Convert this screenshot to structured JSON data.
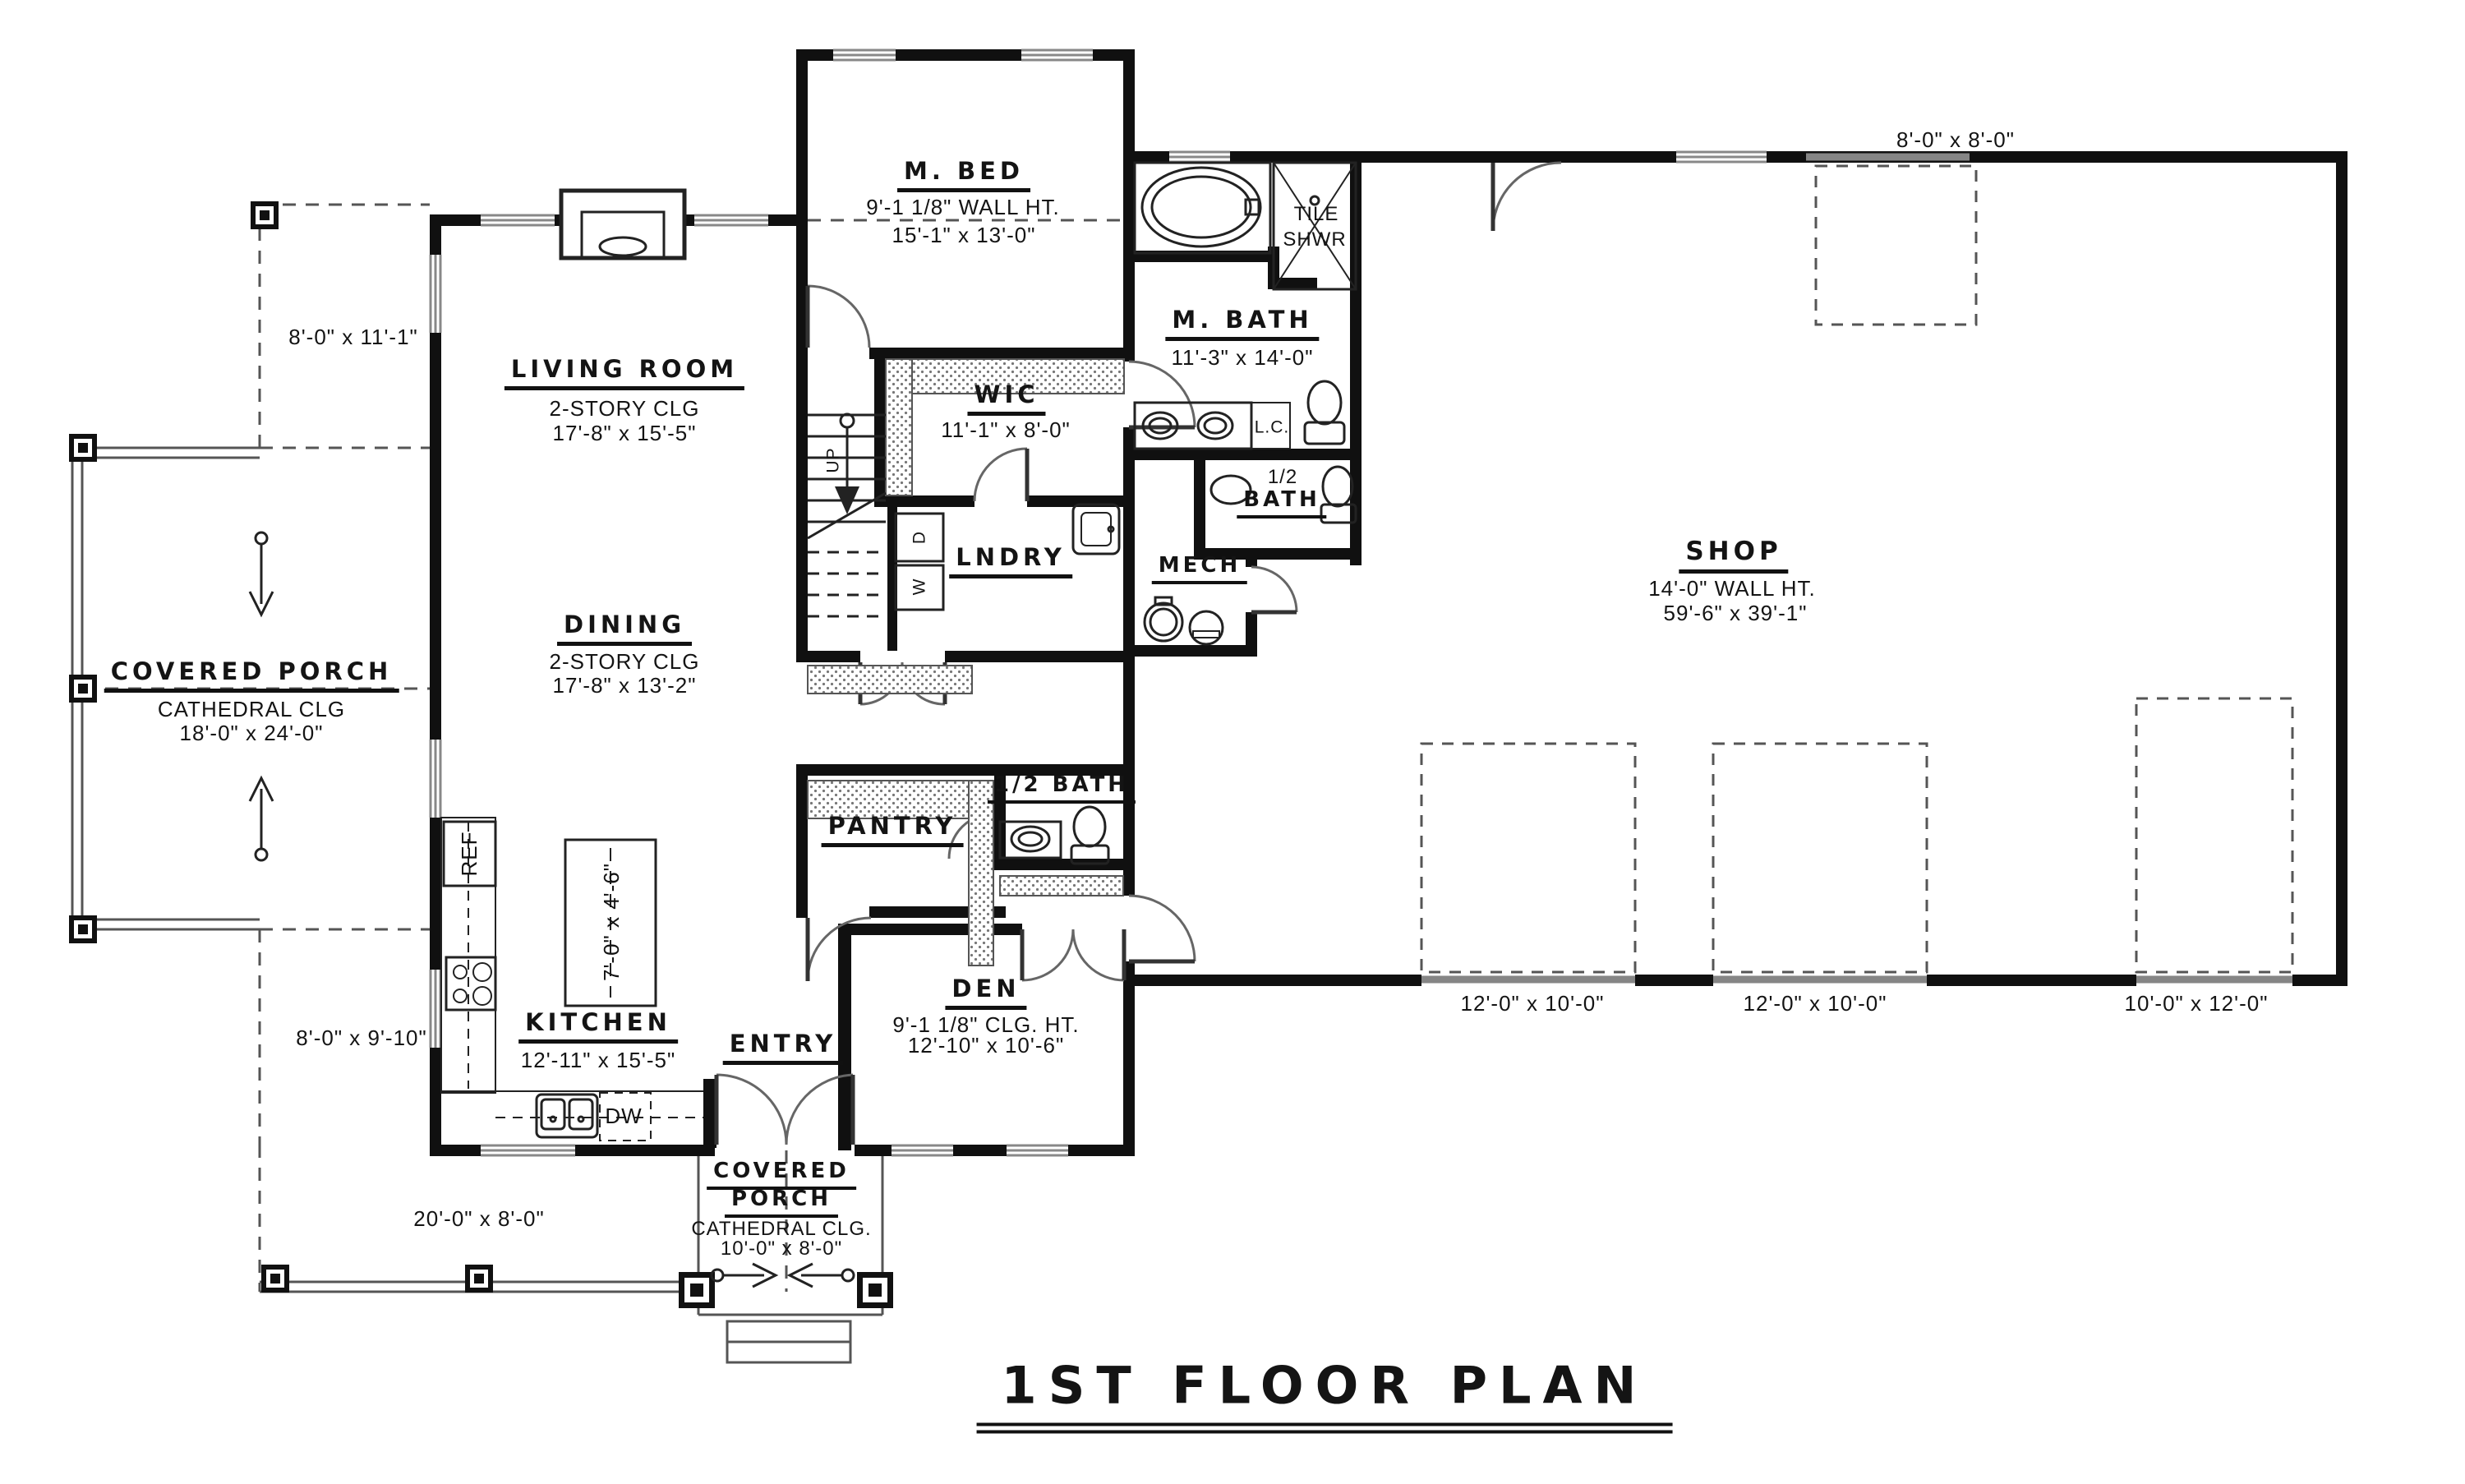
{
  "plan_title": "1ST FLOOR PLAN",
  "rooms": {
    "m_bed": {
      "name": "M. BED",
      "note": "9'-1 1/8\" WALL HT.",
      "dims": "15'-1\" x 13'-0\""
    },
    "living_room": {
      "name": "LIVING ROOM",
      "note": "2-STORY CLG",
      "dims": "17'-8\" x 15'-5\""
    },
    "dining": {
      "name": "DINING",
      "note": "2-STORY CLG",
      "dims": "17'-8\" x 13'-2\""
    },
    "kitchen": {
      "name": "KITCHEN",
      "dims": "12'-11\" x 15'-5\""
    },
    "entry": {
      "name": "ENTRY"
    },
    "den": {
      "name": "DEN",
      "note": "9'-1 1/8\" CLG. HT.",
      "dims": "12'-10\" x 10'-6\""
    },
    "pantry": {
      "name": "PANTRY"
    },
    "half_bath_main": {
      "name": "1/2 BATH"
    },
    "wic": {
      "name": "WIC",
      "dims": "11'-1\" x 8'-0\""
    },
    "lndry": {
      "name": "LNDRY"
    },
    "mech": {
      "name": "MECH"
    },
    "m_bath": {
      "name": "M. BATH",
      "dims": "11'-3\" x 14'-0\""
    },
    "tile_shwr": {
      "line1": "TILE",
      "line2": "SHWR"
    },
    "linen": {
      "name": "L.C."
    },
    "half_bath_upper": {
      "line1": "1/2",
      "line2": "BATH"
    },
    "shop": {
      "name": "SHOP",
      "note": "14'-0\" WALL HT.",
      "dims": "59'-6\" x 39'-1\""
    },
    "porch_left": {
      "name": "COVERED PORCH",
      "note": "CATHEDRAL CLG",
      "dims": "18'-0\" x 24'-0\""
    },
    "porch_entry": {
      "line1": "COVERED",
      "line2": "PORCH",
      "note": "CATHEDRAL CLG.",
      "dims": "10'-0\" x 8'-0\""
    }
  },
  "dims": {
    "porch_upper_left": "8'-0\" x 11'-1\"",
    "porch_lower_left": "8'-0\" x 9'-10\"",
    "porch_bottom": "20'-0\" x 8'-0\"",
    "shop_rear_door": "8'-0\" x 8'-0\"",
    "bay1": "12'-0\" x 10'-0\"",
    "bay2": "12'-0\" x 10'-0\"",
    "bay3": "10'-0\" x 12'-0\"",
    "island": "7'-0\" x 4'-6\""
  },
  "labels": {
    "up": "UP",
    "washer": "W",
    "dryer": "D",
    "ref": "REF",
    "dw": "DW"
  }
}
